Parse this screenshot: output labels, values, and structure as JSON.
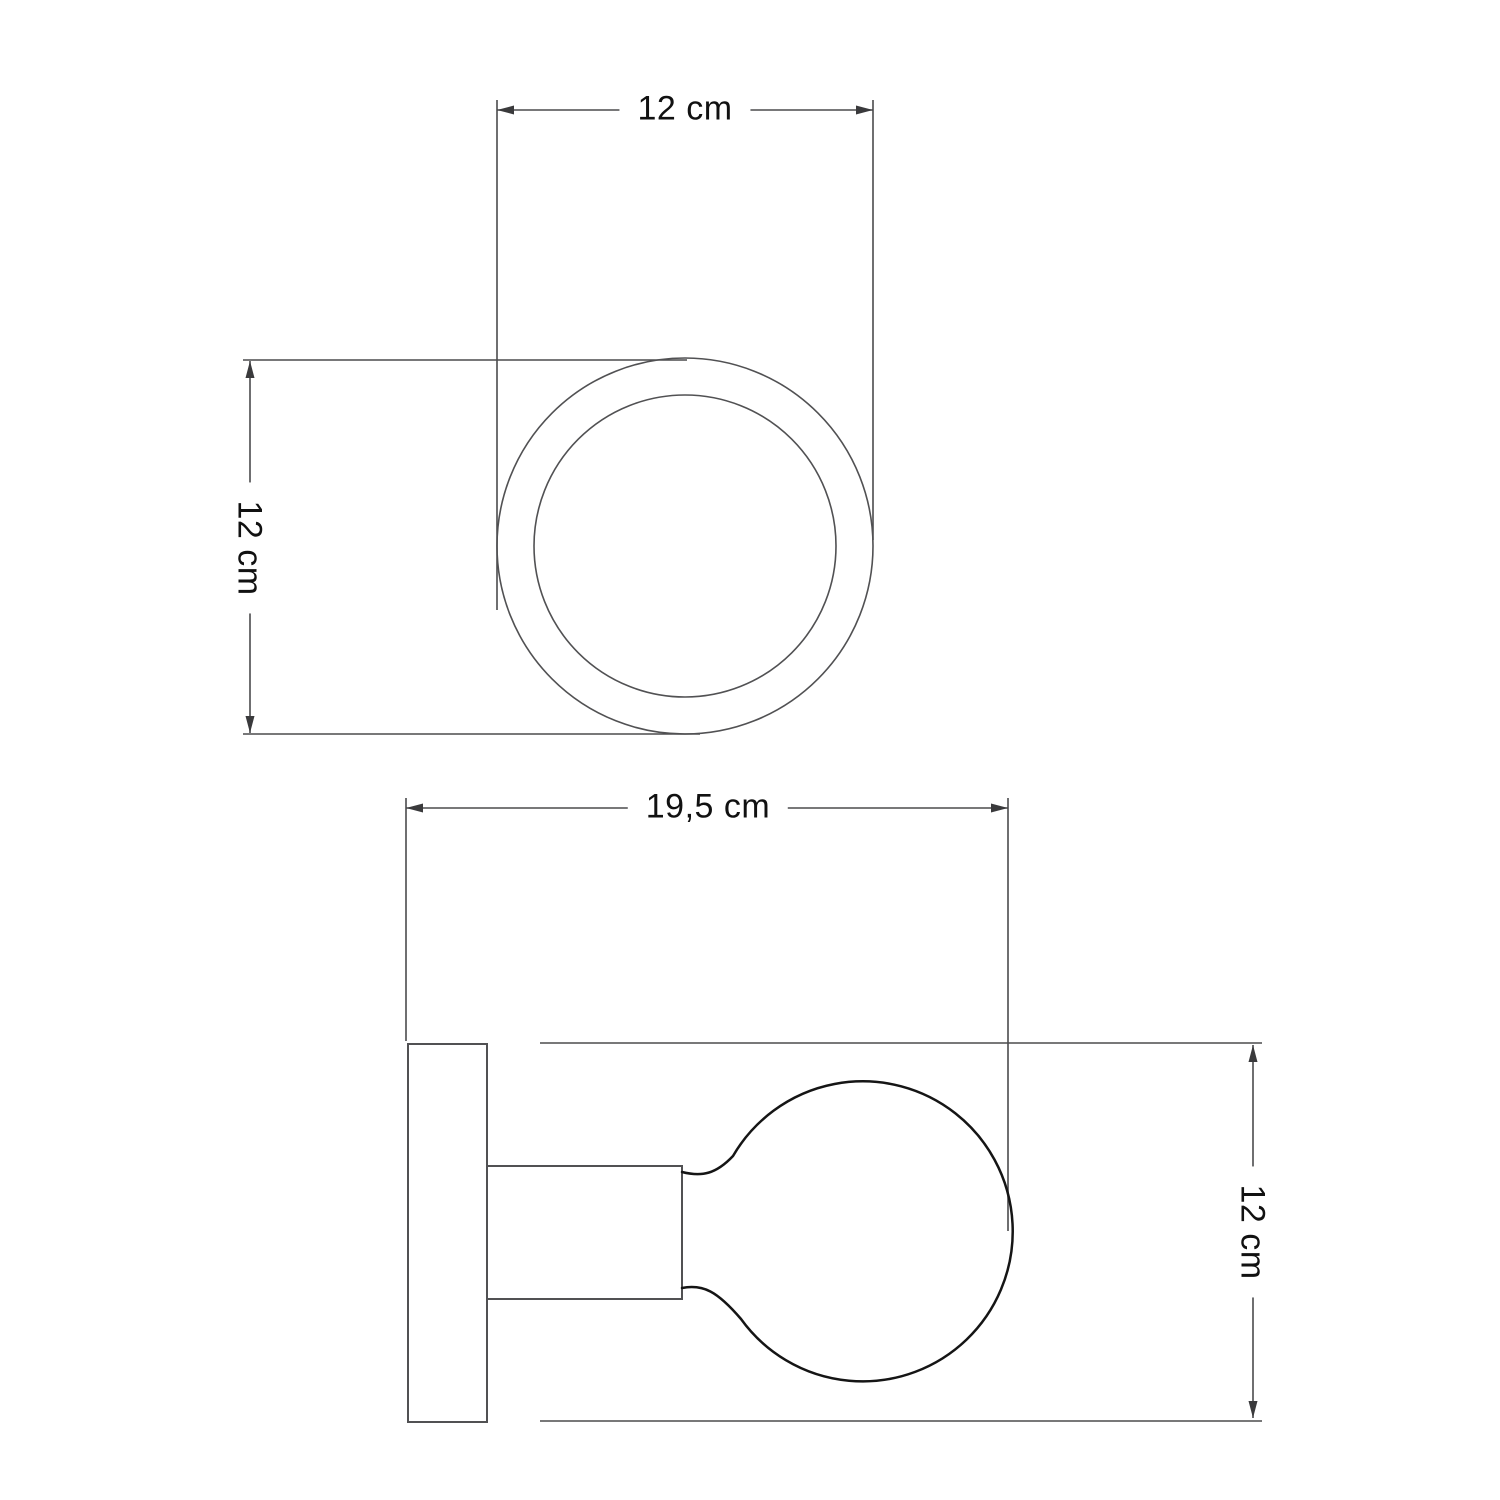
{
  "page": {
    "background": "#ffffff",
    "description": "Technical dimension drawing of a wall spotlight: top view and side view"
  },
  "colors": {
    "dimension_line": "#4b4b4d",
    "product_outline": "#515153",
    "bulb_outline": "#151515",
    "arrow_fill": "#3a3a3c",
    "label_text": "#111111"
  },
  "top_view": {
    "width_dimension": "12 cm",
    "height_dimension": "12 cm"
  },
  "side_view": {
    "width_dimension": "19,5 cm",
    "height_dimension": "12 cm"
  }
}
